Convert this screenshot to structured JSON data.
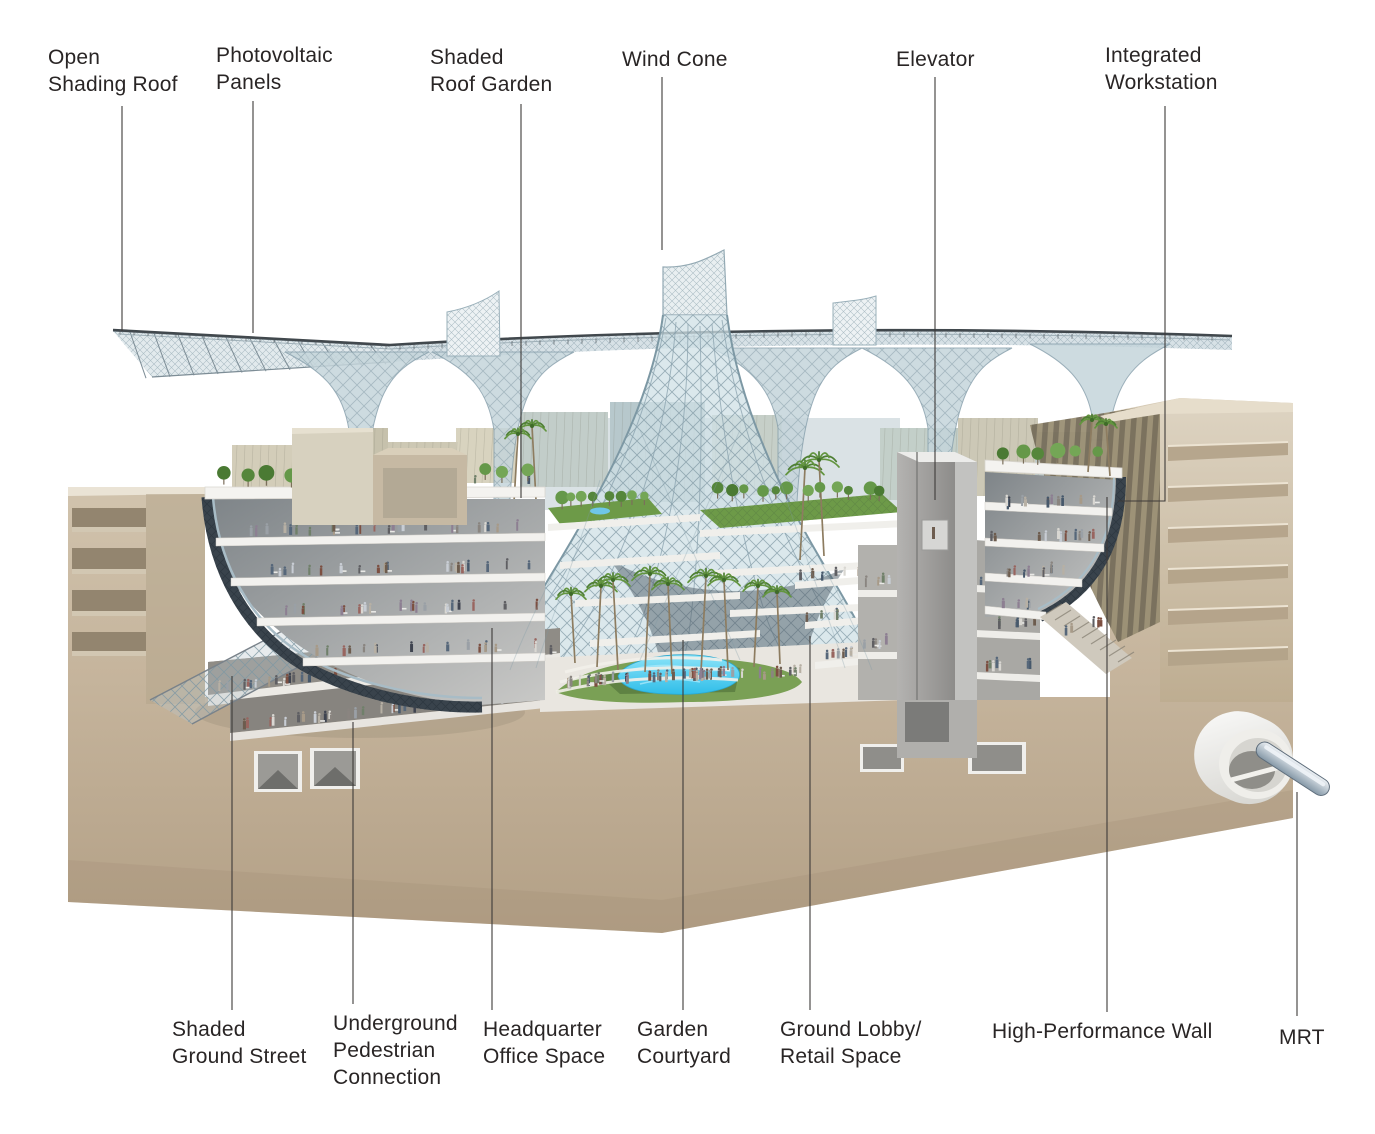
{
  "annotations": {
    "top": [
      {
        "label": "Open\nShading Roof"
      },
      {
        "label": "Photovoltaic\nPanels"
      },
      {
        "label": "Shaded\nRoof Garden"
      },
      {
        "label": "Wind Cone"
      },
      {
        "label": "Elevator"
      },
      {
        "label": "Integrated\nWorkstation"
      }
    ],
    "bottom": [
      {
        "label": "Shaded\nGround Street"
      },
      {
        "label": "Underground\nPedestrian\nConnection"
      },
      {
        "label": "Headquarter\nOffice Space"
      },
      {
        "label": "Garden\nCourtyard"
      },
      {
        "label": "Ground Lobby/\nRetail Space"
      },
      {
        "label": "High-Performance Wall"
      },
      {
        "label": "MRT"
      }
    ]
  },
  "colors": {
    "text": "#292525",
    "leader_line": "#3e3b39",
    "ground_beige": "#c7b8a1",
    "glass_blue": "#c2d3da",
    "pool_blue": "#3cc4ee",
    "lawn_green": "#6d9a48",
    "hull_dark": "#39434c"
  }
}
